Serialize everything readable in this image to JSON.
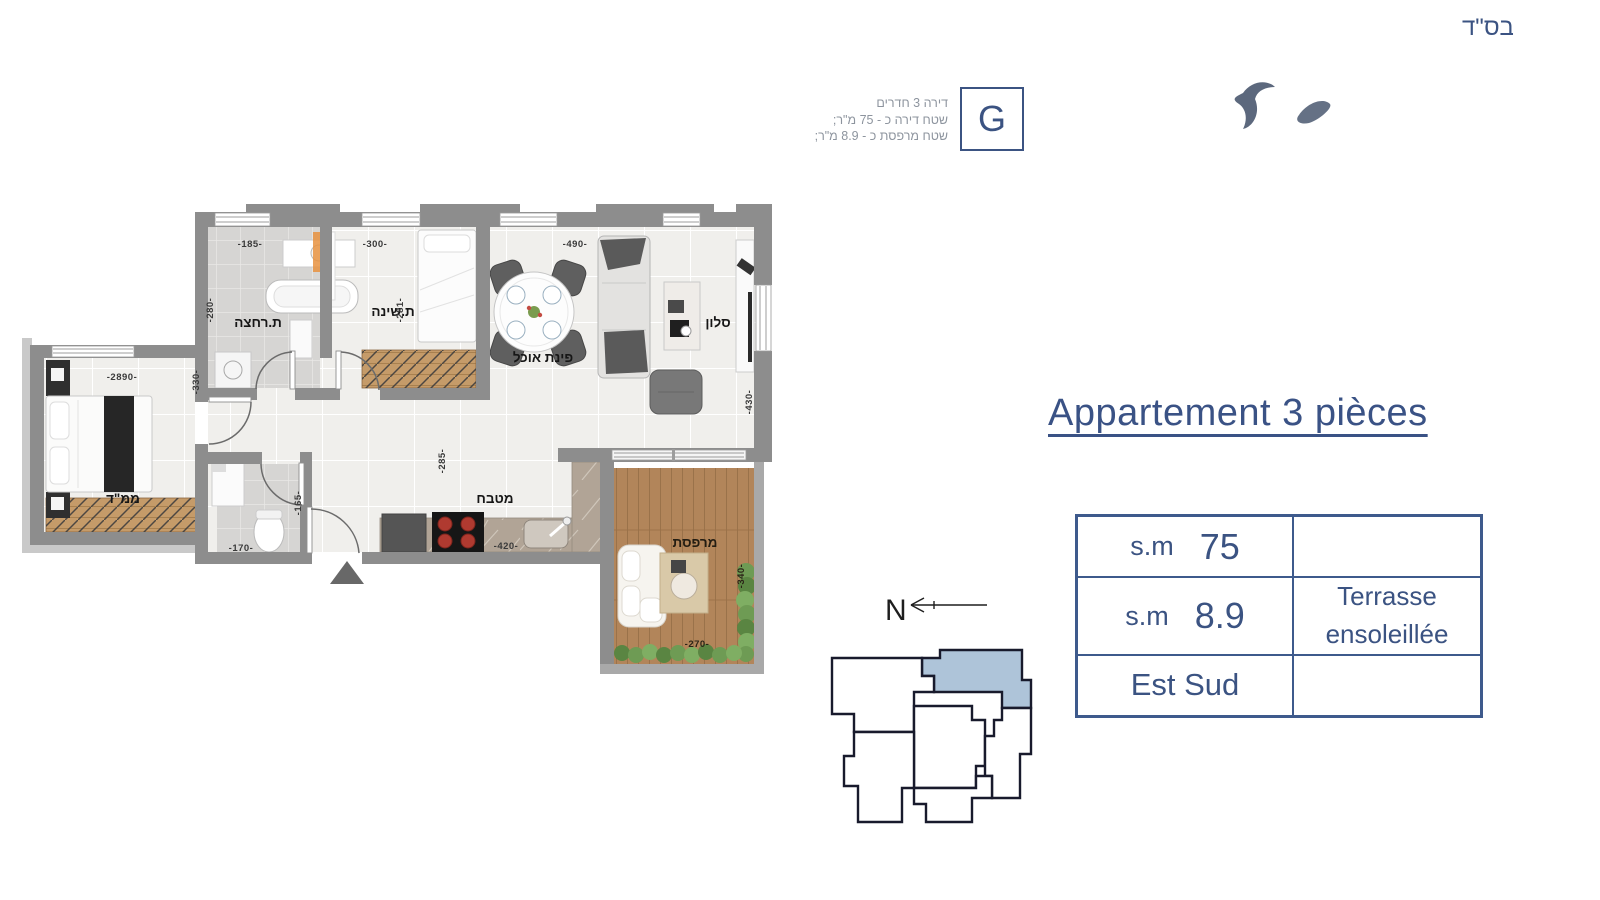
{
  "page": {
    "bsd": "בס\"ד"
  },
  "header": {
    "unit_letter": "G",
    "info": {
      "line1": "דירה 3 חדרים",
      "line2": "שטח דירה כ - 75 מ\"ר;",
      "line3": "שטח מרפסת כ - 8.9 מ\"ר;"
    }
  },
  "plan": {
    "room_labels": {
      "mamad": "ממ\"ד",
      "bathroom": "ת.רחצה",
      "bedroom": "ת.שינה",
      "dining": "פינת אוכל",
      "salon": "סלון",
      "kitchen": "מטבח",
      "balcony": "מרפסת"
    },
    "dimensions": {
      "bathroom_width": "-185-",
      "bedroom_width": "-300-",
      "living_width": "-490-",
      "mamad_width": "-2890-",
      "mamad_height": "-330-",
      "bathroom_height": "-280-",
      "bedroom_height": "-281-",
      "salon_height": "-430-",
      "kitchen_height": "-285-",
      "kitchen_width": "-420-",
      "wc_width": "-170-",
      "wc_height": "-165-",
      "balcony_height": "-340-",
      "balcony_width": "-270-"
    }
  },
  "side": {
    "title": "Appartement 3 pièces",
    "compass": "N",
    "table": {
      "rows": [
        {
          "unit": "s.m",
          "value": "75",
          "note": ""
        },
        {
          "unit": "s.m",
          "value": "8.9",
          "note": "Terrasse ensoleillée"
        },
        {
          "unit": "Est Sud",
          "value": "",
          "note": ""
        }
      ]
    }
  },
  "colors": {
    "accent_blue": "#3b5382",
    "wall_gray": "#8d8d8d",
    "keyplan_highlight": "#aec4d9"
  }
}
